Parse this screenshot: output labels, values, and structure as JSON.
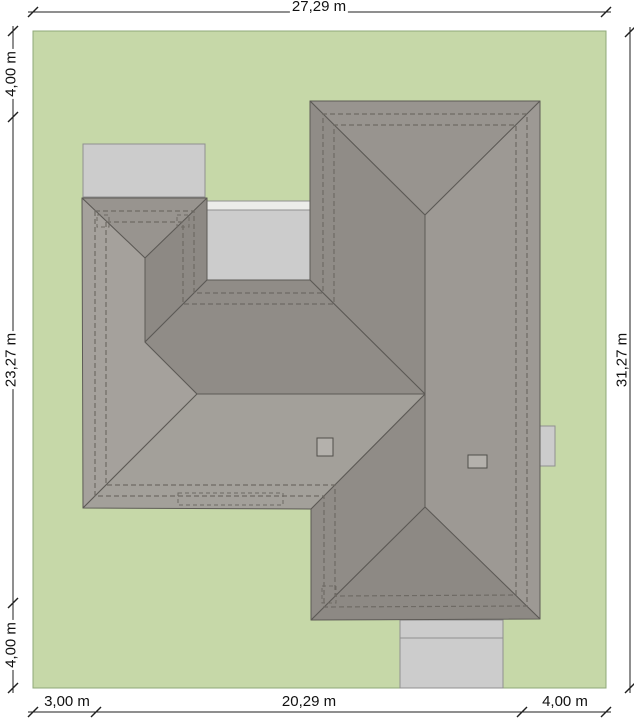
{
  "title": "House roof plan on plot (site plan)",
  "dimensions": {
    "top": "27,29 m",
    "left_top": "4,00 m",
    "left_middle": "23,27 m",
    "left_bottom": "4,00 m",
    "right": "31,27 m",
    "bottom_left": "3,00 m",
    "bottom_center": "20,29 m",
    "bottom_right": "4,00 m"
  },
  "colors": {
    "plot_green": "#c6d8a8",
    "plot_border": "#8fa878",
    "pave_gray": "#cccccc",
    "pave_border": "#909090",
    "roof_nhip": "#98948f",
    "roof_dark": "#908c87",
    "roof_east": "#9d9994",
    "roof_shadow": "#8d8984",
    "roof_west": "#a5a19c",
    "roof_south": "#a3a09a",
    "roof_line": "#5d5a56",
    "dash_line": "#6e6a64",
    "chimney_fill": "#b4b1ac",
    "chimney_line": "#504e4a",
    "dim_line": "#1f1f1f"
  }
}
